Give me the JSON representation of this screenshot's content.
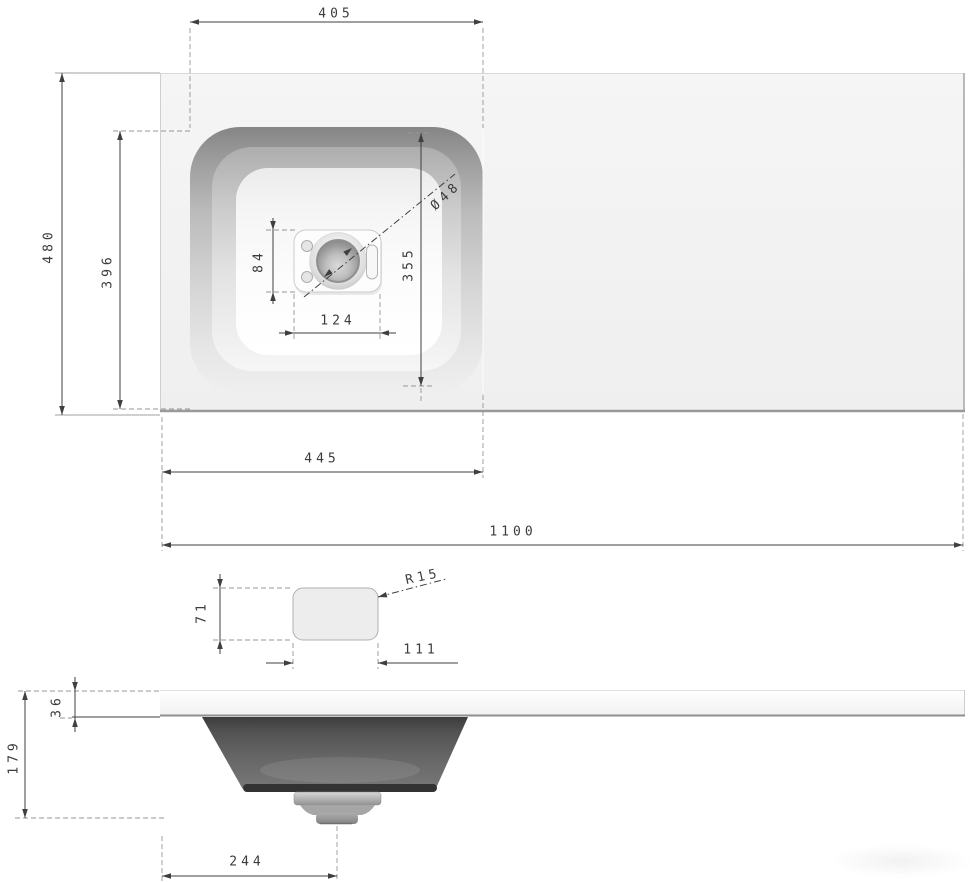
{
  "dimensions": {
    "basin_opening_width": "405",
    "countertop_depth": "480",
    "basin_recess_depth": "396",
    "drain_hole_diameter": "Ø48",
    "drain_plate_depth": "84",
    "basin_floor_depth": "355",
    "drain_plate_width": "124",
    "basin_zone_width": "445",
    "countertop_width": "1100",
    "detail_corner_radius": "R15",
    "detail_height": "71",
    "detail_width": "111",
    "countertop_thickness": "36",
    "total_height": "179",
    "drain_center_offset": "244"
  },
  "colors": {
    "background": "#ffffff",
    "dimension_line": "#3f3f3f",
    "extension_line": "#959595",
    "countertop_fill": "#f3f3f3",
    "basin_rim_dark": "#878787",
    "bowl_dark": "#3c3c3c",
    "drain_metal": "#b5b5b5"
  }
}
